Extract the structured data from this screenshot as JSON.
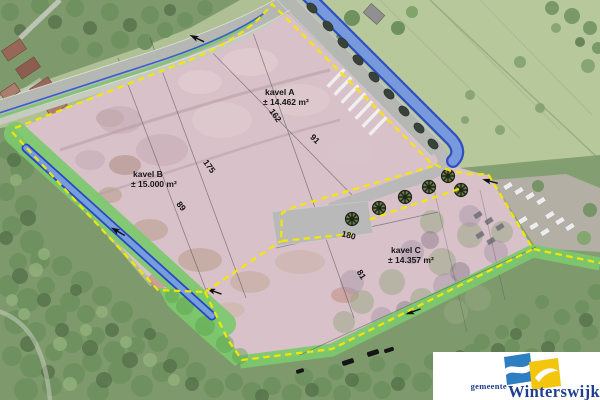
{
  "map": {
    "parcels": [
      {
        "name": "kavel A",
        "area": "± 14.462 m²"
      },
      {
        "name": "kavel B",
        "area": "± 15.000 m²"
      },
      {
        "name": "kavel C",
        "area": "± 14.357 m²"
      }
    ],
    "dimensions": [
      {
        "value": "175"
      },
      {
        "value": "162"
      },
      {
        "value": "91"
      },
      {
        "value": "89"
      },
      {
        "value": "180"
      },
      {
        "value": "81"
      }
    ]
  },
  "logo": {
    "prefix": "gemeente",
    "name": "Winterswijk"
  },
  "colors": {
    "parcel_boundary": "#f6e800",
    "water_overlay": "#2240c8",
    "green_zone": "#7cc96d",
    "road": "#b4b7b2",
    "site_ground": "#d8c1c9",
    "logo_blue": "#2e7fc1",
    "logo_yellow": "#f3c50d",
    "logo_text": "#1e3f8f"
  }
}
